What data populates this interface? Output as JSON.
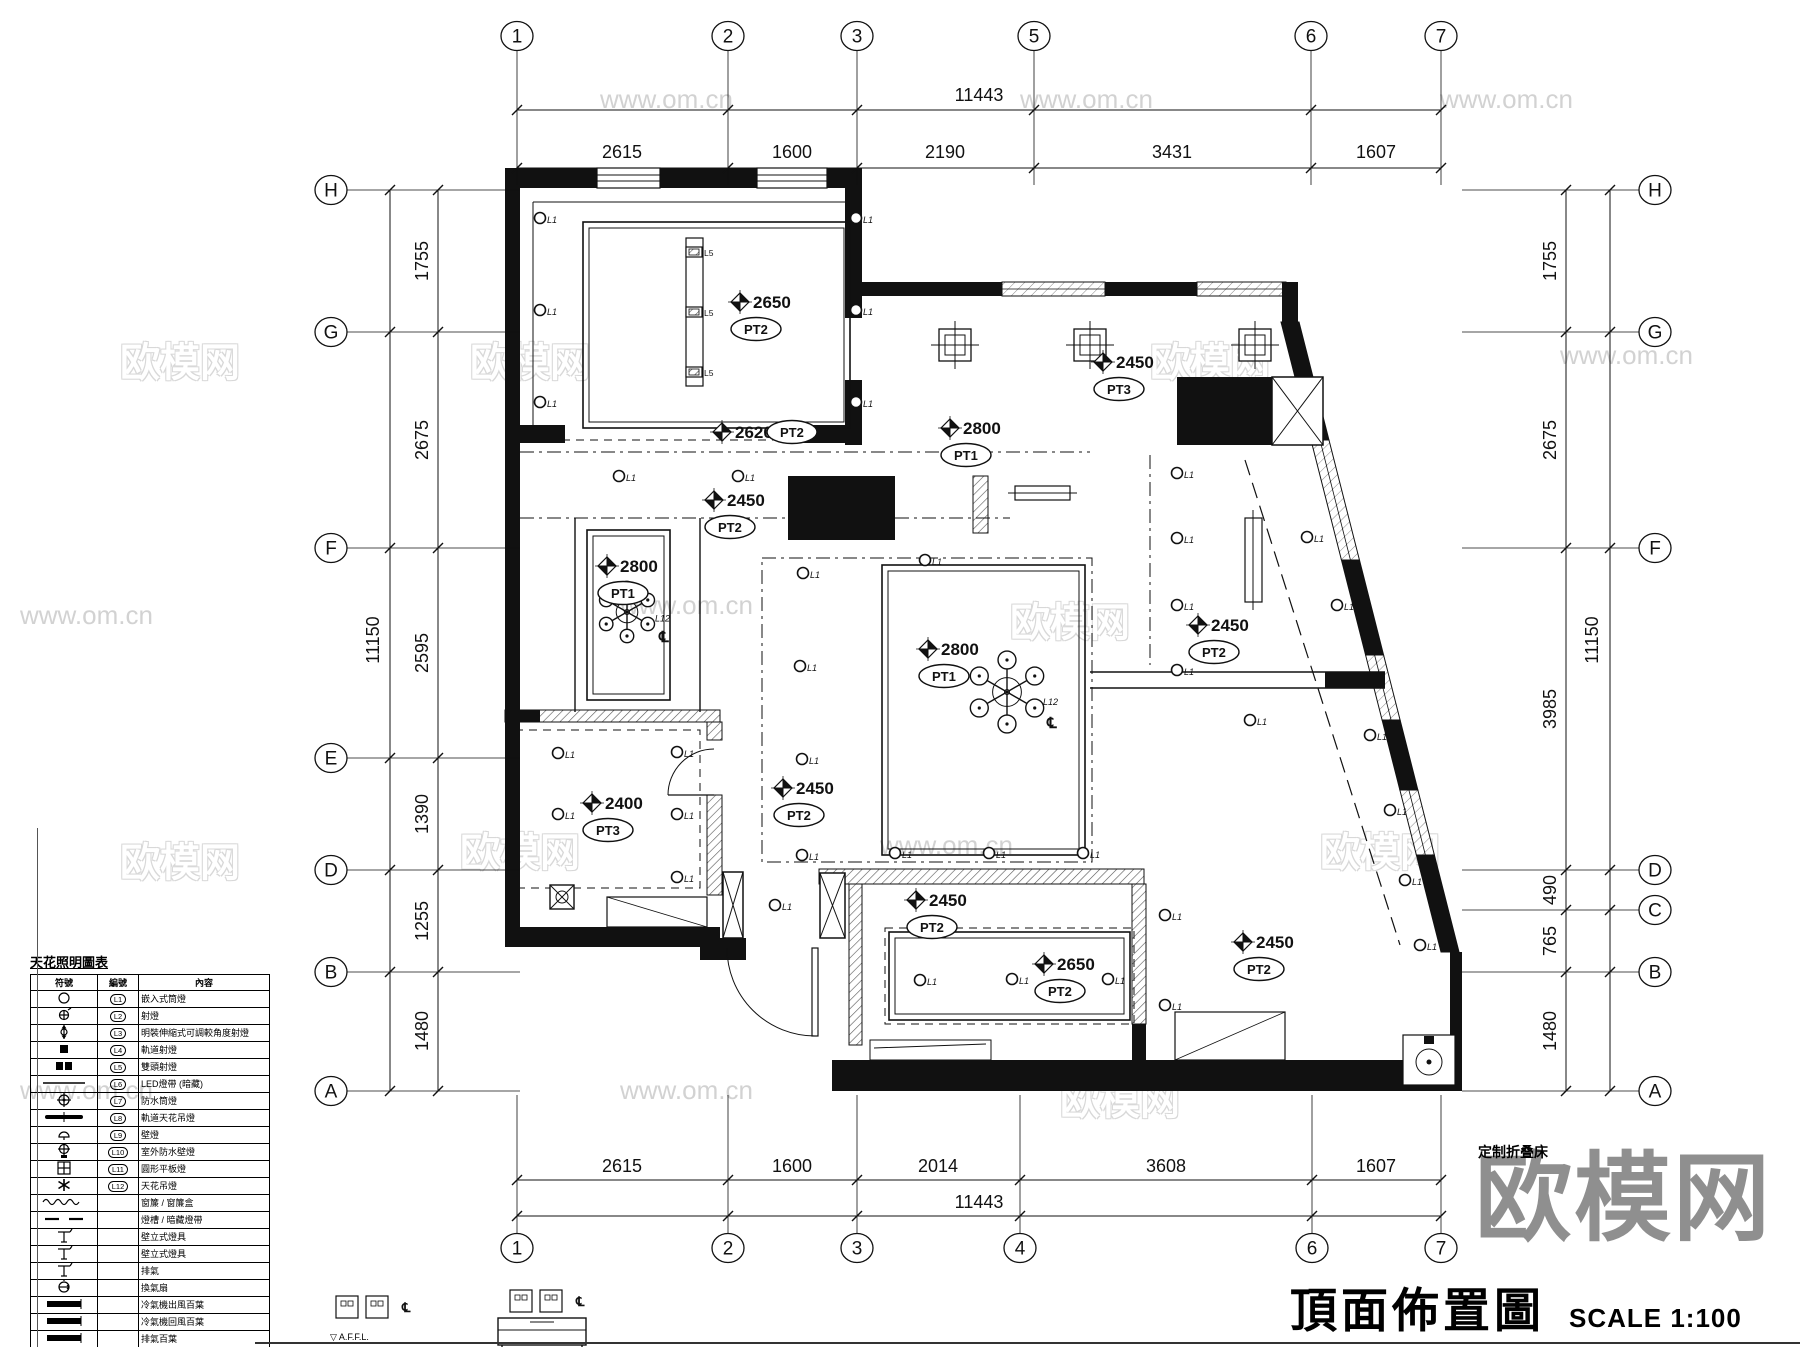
{
  "title": {
    "main": "頂面佈置圖",
    "scale": "SCALE 1:100"
  },
  "watermark": {
    "logo": "欧模网",
    "url": "www.om.cn"
  },
  "notes": {
    "folding_bed": "定制折叠床",
    "affl": "▽ A.F.F.L."
  },
  "codes": {
    "downlight": "L1",
    "track": "L5",
    "chandelier": "L12",
    "centerline": "℄"
  },
  "grid": {
    "top": {
      "y_bubble": 36,
      "y_overall": 110,
      "y_seg": 168,
      "overall": {
        "text": "11443",
        "x": 979,
        "y": 101
      },
      "cols": [
        {
          "label": "1",
          "x": 517
        },
        {
          "label": "2",
          "x": 728
        },
        {
          "label": "3",
          "x": 857
        },
        {
          "label": "5",
          "x": 1034
        },
        {
          "label": "6",
          "x": 1311
        },
        {
          "label": "7",
          "x": 1441
        }
      ],
      "dims": [
        {
          "text": "2615",
          "x": 622
        },
        {
          "text": "1600",
          "x": 792
        },
        {
          "text": "2190",
          "x": 945
        },
        {
          "text": "3431",
          "x": 1172
        },
        {
          "text": "1607",
          "x": 1376
        }
      ]
    },
    "bottom": {
      "y_bubble": 1248,
      "y_overall": 1216,
      "y_seg": 1180,
      "overall": {
        "text": "11443",
        "x": 979,
        "y": 1208
      },
      "cols": [
        {
          "label": "1",
          "x": 517
        },
        {
          "label": "2",
          "x": 728
        },
        {
          "label": "3",
          "x": 857
        },
        {
          "label": "4",
          "x": 1020
        },
        {
          "label": "6",
          "x": 1312
        },
        {
          "label": "7",
          "x": 1441
        }
      ],
      "dims": [
        {
          "text": "2615",
          "x": 622
        },
        {
          "text": "1600",
          "x": 792
        },
        {
          "text": "2014",
          "x": 938
        },
        {
          "text": "3608",
          "x": 1166
        },
        {
          "text": "1607",
          "x": 1376
        }
      ]
    },
    "left": {
      "x_bubble": 331,
      "x_overall": 390,
      "x_seg": 438,
      "overall": {
        "text": "11150",
        "x": 379,
        "y": 640
      },
      "rows": [
        {
          "label": "H",
          "y": 190
        },
        {
          "label": "G",
          "y": 332
        },
        {
          "label": "F",
          "y": 548
        },
        {
          "label": "E",
          "y": 758
        },
        {
          "label": "D",
          "y": 870
        },
        {
          "label": "B",
          "y": 972
        },
        {
          "label": "A",
          "y": 1091
        }
      ],
      "dims": [
        {
          "text": "1755",
          "y": 261
        },
        {
          "text": "2675",
          "y": 440
        },
        {
          "text": "2595",
          "y": 653
        },
        {
          "text": "1390",
          "y": 814
        },
        {
          "text": "1255",
          "y": 921
        },
        {
          "text": "1480",
          "y": 1031
        }
      ]
    },
    "right": {
      "x_bubble": 1655,
      "x_overall": 1610,
      "x_seg": 1566,
      "overall": {
        "text": "11150",
        "x": 1598,
        "y": 640
      },
      "rows": [
        {
          "label": "H",
          "y": 190
        },
        {
          "label": "G",
          "y": 332
        },
        {
          "label": "F",
          "y": 548
        },
        {
          "label": "D",
          "y": 870
        },
        {
          "label": "C",
          "y": 910
        },
        {
          "label": "B",
          "y": 972
        },
        {
          "label": "A",
          "y": 1091
        }
      ],
      "dims": [
        {
          "text": "1755",
          "y": 261
        },
        {
          "text": "2675",
          "y": 440
        },
        {
          "text": "3985",
          "y": 709
        },
        {
          "text": "490",
          "y": 890
        },
        {
          "text": "765",
          "y": 941
        },
        {
          "text": "1480",
          "y": 1031
        }
      ]
    }
  },
  "ceiling_labels": [
    {
      "value": "2650",
      "tag": "PT2",
      "x": 740,
      "y": 302,
      "tagpos": "below"
    },
    {
      "value": "2620",
      "tag": "PT2",
      "x": 722,
      "y": 432,
      "tagpos": "right"
    },
    {
      "value": "2450",
      "tag": "PT2",
      "x": 714,
      "y": 500,
      "tagpos": "below"
    },
    {
      "value": "2800",
      "tag": "PT1",
      "x": 607,
      "y": 566,
      "tagpos": "below"
    },
    {
      "value": "2400",
      "tag": "PT3",
      "x": 592,
      "y": 803,
      "tagpos": "below"
    },
    {
      "value": "2800",
      "tag": "PT1",
      "x": 928,
      "y": 649,
      "tagpos": "below"
    },
    {
      "value": "2450",
      "tag": "PT2",
      "x": 783,
      "y": 788,
      "tagpos": "below"
    },
    {
      "value": "2800",
      "tag": "PT1",
      "x": 950,
      "y": 428,
      "tagpos": "below"
    },
    {
      "value": "2450",
      "tag": "PT3",
      "x": 1103,
      "y": 362,
      "tagpos": "below"
    },
    {
      "value": "2450",
      "tag": "PT2",
      "x": 1198,
      "y": 625,
      "tagpos": "below"
    },
    {
      "value": "2450",
      "tag": "PT2",
      "x": 916,
      "y": 900,
      "tagpos": "below"
    },
    {
      "value": "2650",
      "tag": "PT2",
      "x": 1044,
      "y": 964,
      "tagpos": "below"
    },
    {
      "value": "2450",
      "tag": "PT2",
      "x": 1243,
      "y": 942,
      "tagpos": "below"
    }
  ],
  "downlights": [
    [
      540,
      218
    ],
    [
      540,
      310
    ],
    [
      540,
      402
    ],
    [
      856,
      218
    ],
    [
      856,
      310
    ],
    [
      856,
      402
    ],
    [
      619,
      476
    ],
    [
      738,
      476
    ],
    [
      803,
      573
    ],
    [
      800,
      666
    ],
    [
      802,
      759
    ],
    [
      802,
      855
    ],
    [
      925,
      560
    ],
    [
      895,
      853
    ],
    [
      989,
      853
    ],
    [
      1083,
      853
    ],
    [
      558,
      753
    ],
    [
      677,
      752
    ],
    [
      558,
      814
    ],
    [
      677,
      814
    ],
    [
      677,
      877
    ],
    [
      1177,
      473
    ],
    [
      1177,
      538
    ],
    [
      1177,
      605
    ],
    [
      1177,
      670
    ],
    [
      1307,
      537
    ],
    [
      1337,
      605
    ],
    [
      1370,
      735
    ],
    [
      1390,
      810
    ],
    [
      1405,
      880
    ],
    [
      1420,
      945
    ],
    [
      920,
      980
    ],
    [
      1012,
      979
    ],
    [
      1108,
      979
    ],
    [
      1165,
      915
    ],
    [
      1165,
      1005
    ],
    [
      1250,
      720
    ],
    [
      775,
      905
    ]
  ],
  "track_heads": [
    [
      694,
      252
    ],
    [
      694,
      312
    ],
    [
      694,
      372
    ]
  ],
  "square_lights": [
    [
      955,
      345
    ],
    [
      1090,
      345
    ],
    [
      1255,
      345
    ]
  ],
  "chandeliers": [
    {
      "x": 627,
      "y": 612,
      "r": 24
    },
    {
      "x": 1007,
      "y": 692,
      "r": 32
    }
  ],
  "watermarks": [
    {
      "t": "www.om.cn",
      "x": 600,
      "y": 84,
      "o": 0
    },
    {
      "t": "www.om.cn",
      "x": 1020,
      "y": 84,
      "o": 0
    },
    {
      "t": "www.om.cn",
      "x": 1440,
      "y": 84,
      "o": 0
    },
    {
      "t": "欧模网",
      "x": 120,
      "y": 330,
      "o": 1
    },
    {
      "t": "欧模网",
      "x": 470,
      "y": 330,
      "o": 1
    },
    {
      "t": "欧模网",
      "x": 1150,
      "y": 330,
      "o": 1
    },
    {
      "t": "www.om.cn",
      "x": 1560,
      "y": 340,
      "o": 0
    },
    {
      "t": "www.om.cn",
      "x": 20,
      "y": 600,
      "o": 0
    },
    {
      "t": "www.om.cn",
      "x": 620,
      "y": 590,
      "o": 0
    },
    {
      "t": "欧模网",
      "x": 1010,
      "y": 590,
      "o": 1
    },
    {
      "t": "欧模网",
      "x": 120,
      "y": 830,
      "o": 1
    },
    {
      "t": "欧模网",
      "x": 460,
      "y": 820,
      "o": 1
    },
    {
      "t": "www.om.cn",
      "x": 880,
      "y": 830,
      "o": 0
    },
    {
      "t": "欧模网",
      "x": 1320,
      "y": 820,
      "o": 1
    },
    {
      "t": "www.om.cn",
      "x": 620,
      "y": 1075,
      "o": 0
    },
    {
      "t": "欧模网",
      "x": 1060,
      "y": 1068,
      "o": 1
    },
    {
      "t": "www.om.cn",
      "x": 20,
      "y": 1075,
      "o": 0
    }
  ],
  "legend": {
    "title": "天花照明圖表",
    "headers": [
      "符號",
      "編號",
      "內容"
    ],
    "rows": [
      {
        "sym": "circle",
        "code": "L1",
        "desc": "嵌入式筒燈"
      },
      {
        "sym": "spot",
        "code": "L2",
        "desc": "射燈"
      },
      {
        "sym": "adj",
        "code": "L3",
        "desc": "明裝伸縮式可調較角度射燈"
      },
      {
        "sym": "sq",
        "code": "L4",
        "desc": "軌道射燈"
      },
      {
        "sym": "sq2",
        "code": "L5",
        "desc": "雙頭射燈"
      },
      {
        "sym": "line",
        "code": "L6",
        "desc": "LED燈帶 (暗藏)"
      },
      {
        "sym": "crosshair",
        "code": "L7",
        "desc": "防水筒燈"
      },
      {
        "sym": "bar",
        "code": "L8",
        "desc": "軌道天花吊燈"
      },
      {
        "sym": "walllamp",
        "code": "L9",
        "desc": "壁燈"
      },
      {
        "sym": "crosshair2",
        "code": "L10",
        "desc": "室外防水壁燈"
      },
      {
        "sym": "gridsq",
        "code": "L11",
        "desc": "圓形平板燈"
      },
      {
        "sym": "star",
        "code": "L12",
        "desc": "天花吊燈"
      },
      {
        "sym": "wavy",
        "code": "",
        "desc": "窗簾 / 窗簾盒"
      },
      {
        "sym": "dashes",
        "code": "",
        "desc": "燈槽 / 暗藏燈帶"
      },
      {
        "sym": "tpin",
        "code": "",
        "desc": "壁立式燈具"
      },
      {
        "sym": "tpin",
        "code": "",
        "desc": "壁立式燈具"
      },
      {
        "sym": "tpin",
        "code": "",
        "desc": "排氣"
      },
      {
        "sym": "fan",
        "code": "",
        "desc": "換氣扇"
      },
      {
        "sym": "louver",
        "code": "",
        "desc": "冷氣機出風百葉"
      },
      {
        "sym": "louver",
        "code": "",
        "desc": "冷氣機回風百葉"
      },
      {
        "sym": "louver",
        "code": "",
        "desc": "排氣百葉"
      },
      {
        "sym": "bathheater",
        "code": "",
        "desc": "浴霸"
      }
    ]
  }
}
